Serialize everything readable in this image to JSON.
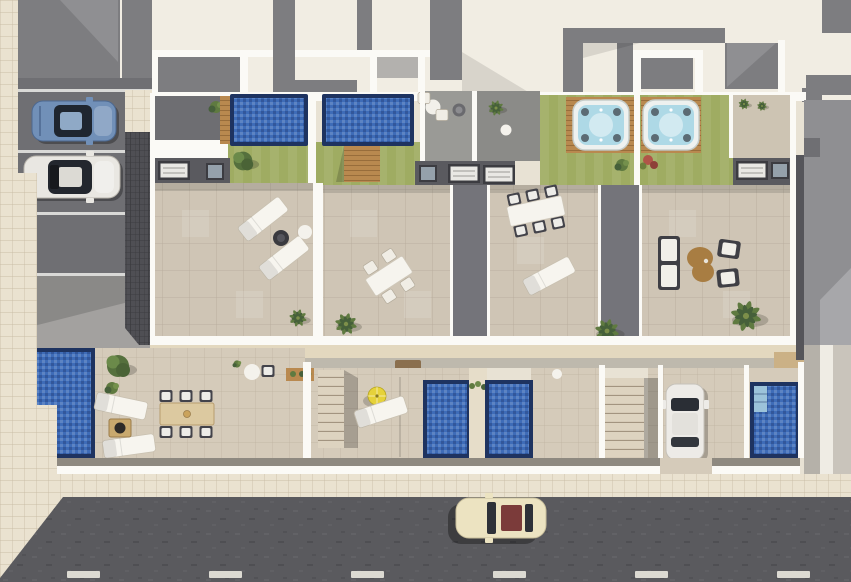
{
  "scene": {
    "type": "architectural-aerial-render",
    "view": "top-down",
    "description": "Aerial 3D render of a row of four townhouses with rooftop solariums (lap pools, hot tubs, lawns), ground-floor patios with pools, street-side parking and a road with a passing car",
    "width": 851,
    "height": 582
  },
  "palette": {
    "cream_roof": "#f1ede3",
    "roof_gray": "#7d7d80",
    "roof_gray_light": "#a7a7aa",
    "white_wall": "#fbfaf6",
    "parking_asphalt": "#6f6f73",
    "apron_concrete": "#a3a19f",
    "paver_dark": "#4f4f54",
    "court_dark": "#6e6e72",
    "court_mid": "#9a9a96",
    "court_light": "#8b8b88",
    "entry_court_beige": "#cdc4b3",
    "road": "#5a5a5e",
    "road_line": "#dcdad2",
    "sidewalk_tile": "#eae2d0",
    "terrace_tile": "#cfc5b5",
    "patio_tile": "#d5cbba",
    "wall_tan": "#e3d8bf",
    "lawn": "#9fac62",
    "pool_border": "#1e3360",
    "pool_water": "#3e6cb8",
    "pool_steps": "#9cc3da",
    "hot_tub_water": "#aed9e6",
    "hot_tub_shell": "#eef1ef",
    "deck_wood": "#b9894f",
    "wood_table": "#dcc9a0",
    "furniture_white": "#f6f4ee",
    "furniture_dark": "#3f3f45",
    "coffee_table_brown": "#a87d42",
    "umbrella_yellow": "#e6d23a",
    "plant_green": "#5f7a40",
    "plant_dark_green": "#46603a",
    "plant_red": "#b05548",
    "neighbor_gray": "#8f8f92",
    "stair_tread": "#ddd3c0"
  },
  "parking": {
    "space_count": 3,
    "cars": [
      {
        "name": "blue-car",
        "color_hex": "#7190b8"
      },
      {
        "name": "white-car",
        "color_hex": "#e9e7e2"
      }
    ]
  },
  "street": {
    "car": {
      "name": "cream-car",
      "color_hex": "#ece3c1",
      "roof_accent_hex": "#7b3b3a"
    },
    "driveway_car": {
      "name": "white-driveway-car",
      "color_hex": "#edebe7"
    },
    "lane_dash_count": 6
  },
  "units": [
    {
      "id": 1,
      "rooftop": "lap pool, lawn with tree, shaded court",
      "roof_furniture": "2 sun loungers, fire bowl, side table",
      "ground": "corner pool, timber dining table for 6, 2 loungers, fire pit, bistro table"
    },
    {
      "id": 2,
      "rooftop": "lap pool, deck steps, lawn",
      "roof_furniture": "dining table for 4, palm",
      "ground": "pool, yellow parasol, lounger, staircase"
    },
    {
      "id": 3,
      "rooftop": "hot tub on timber deck, lawn",
      "roof_furniture": "dining table for 6, sun lounger",
      "ground": "pool, open patio"
    },
    {
      "id": 4,
      "rooftop": "hot tub on timber deck, lawn, entry court with palms",
      "roof_furniture": "lounge sofa, 2 armchairs, kidney coffee table, palm",
      "ground": "pool with steps, carport with white car, staircase"
    }
  ],
  "counts": {
    "rooftop_lap_pools": 2,
    "hot_tubs": 2,
    "ground_pools": 4,
    "sun_loungers": 6,
    "dining_sets": 3,
    "lounge_sets": 1,
    "palm_trees": 5,
    "parasols": 1,
    "cars_total": 4
  }
}
